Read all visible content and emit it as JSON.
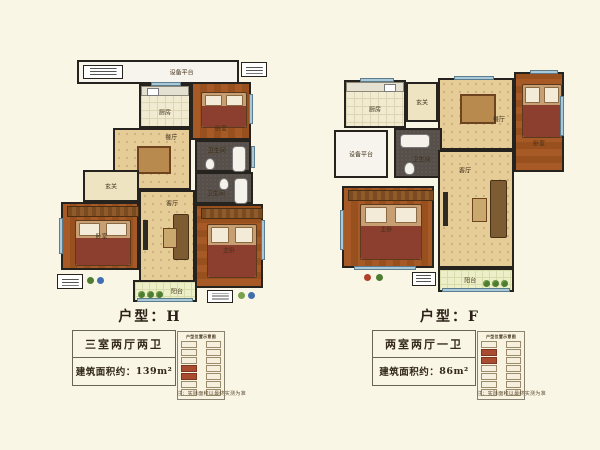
{
  "page": {
    "background": "#faf6e5"
  },
  "colors": {
    "wall": "#26221d",
    "window": "#a9c9d8",
    "highlight_unit": "#a84b2f",
    "floor_grid": "#e6cc96",
    "floor_wood": "#a0562a"
  },
  "plans": [
    {
      "name": "H",
      "title": "户型：H",
      "spec": "三室两厅两卫",
      "area_label": "建筑面积约：",
      "area_value": "139m²",
      "note": "注：实际面积以最终实测为准",
      "rooms": {
        "equipment": "设备平台",
        "kitchen": "厨房",
        "dining": "餐厅",
        "entry": "玄关",
        "bedroom_top": "卧室",
        "bath_upper": "卫生间",
        "bath_lower": "卫生间",
        "bedroom_left": "卧室",
        "living": "客厅",
        "master": "主卧",
        "balcony": "阳台"
      },
      "key_plate": {
        "caption": "户型位置示意图",
        "rows": 7,
        "highlighted_left": [
          3,
          4
        ],
        "highlighted_right": []
      }
    },
    {
      "name": "F",
      "title": "户型：F",
      "spec": "两室两厅一卫",
      "area_label": "建筑面积约：",
      "area_value": "86m²",
      "note": "注：实际面积以最终实测为准",
      "rooms": {
        "equipment": "设备平台",
        "kitchen": "厨房",
        "entry": "玄关",
        "dining": "餐厅",
        "bedroom": "卧室",
        "bath": "卫生间",
        "master": "主卧",
        "living": "客厅",
        "balcony": "阳台"
      },
      "key_plate": {
        "caption": "户型位置示意图",
        "rows": 7,
        "highlighted_left": [
          1,
          2
        ],
        "highlighted_right": []
      }
    }
  ]
}
